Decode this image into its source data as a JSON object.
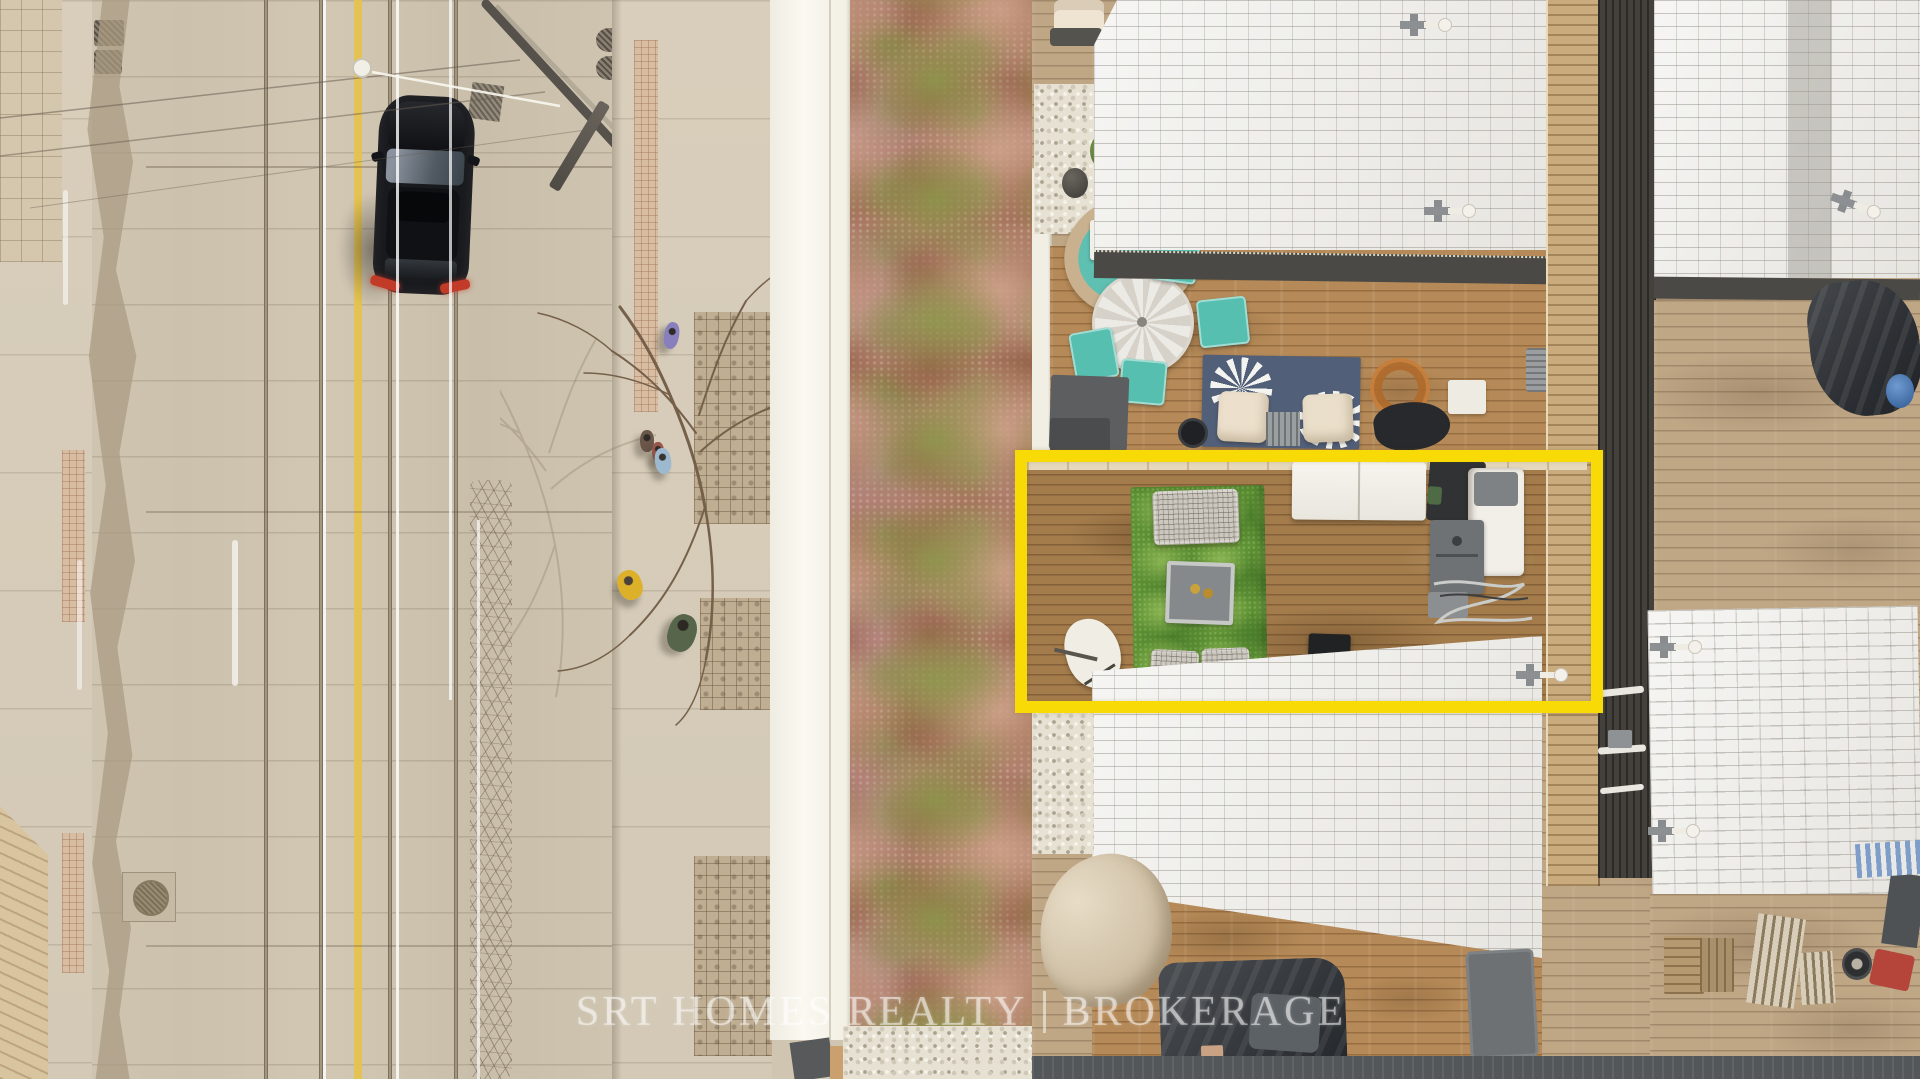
{
  "photo": {
    "kind": "aerial-drone-photo",
    "subject": "urban rooftop terrace real-estate listing, top-down view"
  },
  "watermark": {
    "part1": "SRT HOMES REALTY",
    "separator": "|",
    "part2": "BROKERAGE",
    "color": "rgba(255,255,255,0.52)"
  },
  "highlight_box": {
    "label": "subject-property-outline",
    "color": "#F8DA06",
    "x": 1015,
    "y": 450,
    "width": 588,
    "height": 263,
    "stroke_px": 12
  },
  "palette": {
    "street_concrete": "#cdc3af",
    "road_yellow_line": "#e5c34f",
    "overhead_wire_white": "rgba(255,255,255,0.8)",
    "car_black": "#191a1e",
    "taillight_red": "#c23a28",
    "parapet_white": "#f4f1e8",
    "sedum_rust": "#a8775f",
    "sedum_olive": "#8c9a4a",
    "deck_wood": "#b68a58",
    "shingle_white": "#edece8",
    "turf_green": "#5e9234",
    "teal_furniture": "#57bfb0",
    "tarp_dark": "#3c4044",
    "canopy_tan": "#d9c9b2"
  },
  "scene": {
    "street": [
      "streetcar-rails",
      "yellow-centre-line",
      "overhead-wires",
      "black-suv",
      "streetlight",
      "utility-pole",
      "manhole",
      "storm-grates",
      "pavement-cracks"
    ],
    "sidewalk": [
      "bare-tree",
      "tree-shadow",
      "pink-tile-strip",
      "mosaic-tile-patches",
      "pedestrian-purple",
      "pedestrian-lightblue",
      "pedestrian-pair",
      "pedestrian-yellow",
      "pedestrian-green"
    ],
    "green_roof": [
      "sedum-mat",
      "pebble-border"
    ],
    "terraces": [
      "white-shingle-roofs",
      "wood-decks",
      "privacy-fence",
      "dark-roof-strip",
      "round-dining-table",
      "teal-chairs",
      "wicker-ring-chair",
      "floral-outdoor-rug",
      "cream-ottomans",
      "speaker",
      "artificial-turf-rug",
      "wicker-sofa",
      "wicker-chairs",
      "fire-table",
      "patio-umbrella-base",
      "white-folding-table",
      "bbq-grill",
      "white-utility-tub",
      "garden-hose",
      "black-storage-box",
      "freezer-box",
      "ac-unit",
      "orange-extension-cord",
      "black-tarps",
      "beige-canopy",
      "roof-anchors",
      "storage-crates",
      "slat-boards",
      "spare-tire",
      "red-object",
      "blue-barrel",
      "rubber-walkway"
    ]
  }
}
